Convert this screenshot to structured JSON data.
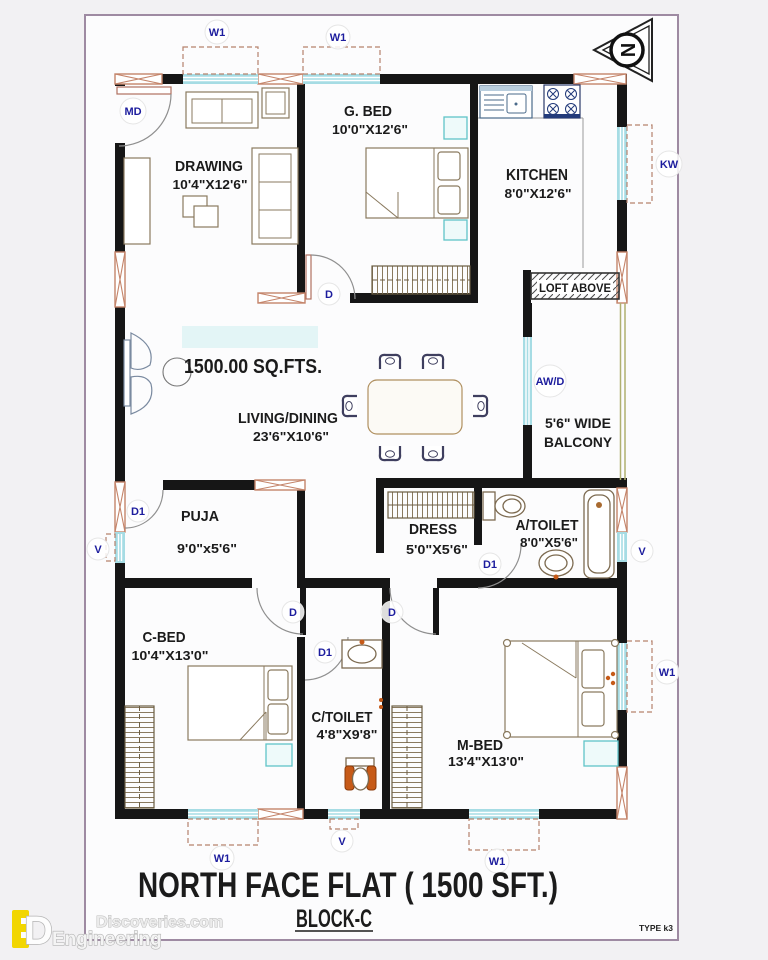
{
  "title": {
    "main": "NORTH FACE FLAT ( 1500 SFT.)",
    "block": "BLOCK-C",
    "type_code": "TYPE k3"
  },
  "area_note": "1500.00 SQ.FTS.",
  "compass": {
    "letter": "N"
  },
  "rooms": {
    "drawing": {
      "name": "DRAWING",
      "dims": "10'4\"X12'6\""
    },
    "g_bed": {
      "name": "G. BED",
      "dims": "10'0\"X12'6\""
    },
    "kitchen": {
      "name": "KITCHEN",
      "dims": "8'0\"X12'6\""
    },
    "living": {
      "name": "LIVING/DINING",
      "dims": "23'6\"X10'6\""
    },
    "balcony": {
      "line1": "5'6\" WIDE",
      "line2": "BALCONY"
    },
    "loft": {
      "name": "LOFT ABOVE"
    },
    "puja": {
      "name": "PUJA",
      "dims": "9'0\"x5'6\""
    },
    "dress": {
      "name": "DRESS",
      "dims": "5'0\"X5'6\""
    },
    "a_toilet": {
      "name": "A/TOILET",
      "dims": "8'0\"X5'6\""
    },
    "c_bed": {
      "name": "C-BED",
      "dims": "10'4\"X13'0\""
    },
    "c_toilet": {
      "name": "C/TOILET",
      "dims": "4'8\"X9'8\""
    },
    "m_bed": {
      "name": "M-BED",
      "dims": "13'4\"X13'0\""
    }
  },
  "openings": {
    "window": "W1",
    "main_door": "MD",
    "kitchen_window": "KW",
    "utility": "AW/D",
    "vent": "V",
    "door": "D",
    "door_small": "D1"
  },
  "watermark": {
    "site": "Discoveries.com",
    "brand": "Engineering"
  },
  "colors": {
    "wall": "#161616",
    "window_glass": "#a6dce4",
    "infill_outline": "#c4846a",
    "label_navy": "#1d1d9e",
    "sheet_border": "#9e8aa2",
    "fixture_orange": "#c65a18"
  }
}
